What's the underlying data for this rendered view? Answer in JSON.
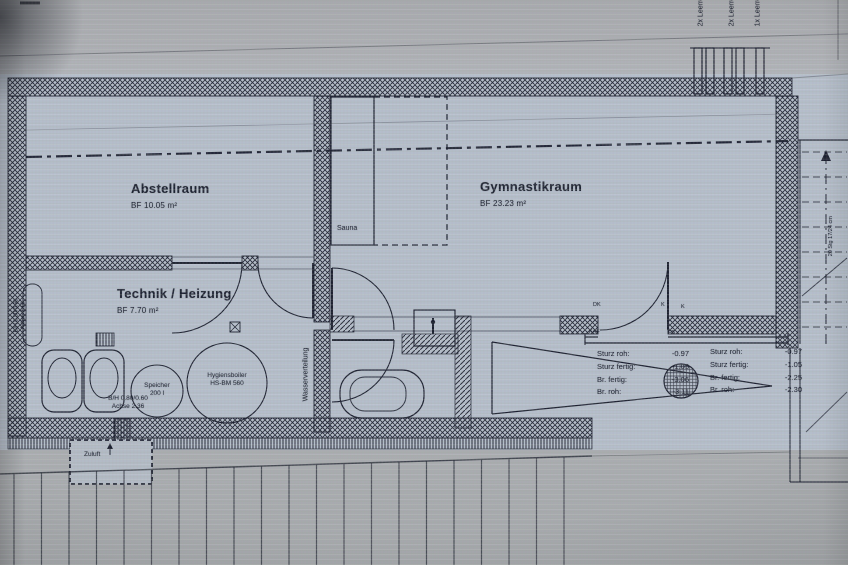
{
  "colors": {
    "paper_blue": "#b4becb",
    "paper_gray_top": "#a9acb1",
    "paper_gray_bottom": "#a5a9ad",
    "ink": "#1d2332",
    "wall_ink": "#1b2030"
  },
  "rooms": {
    "abstellraum": {
      "name": "Abstellraum",
      "area": "BF 10.05 m²"
    },
    "gymnastikraum": {
      "name": "Gymnastikraum",
      "area": "BF 23.23 m²"
    },
    "technik": {
      "name": "Technik / Heizung",
      "area": "BF 7.70 m²"
    },
    "sauna": {
      "name": "Sauna"
    }
  },
  "equipment": {
    "speicher": {
      "line1": "Speicher",
      "line2": "200 l"
    },
    "boiler": {
      "line1": "Hygiensboiler",
      "line2": "HS-BM 560"
    }
  },
  "annotations": {
    "leerrohr1": "2x Leerrohr",
    "leerrohr2": "2x Leerrohr",
    "leerrohr3": "1x Leerrohr",
    "zuluft": "Zuluft",
    "wasserverteilung": "Wasserverteilung",
    "stair_note": "20 Stg 17/24 cm",
    "lintel_wall": {
      "line1": "B/H 0.80/0.60",
      "line2": "Achse 2.16"
    },
    "lintel_technik": {
      "line1": "B/H 0.80/0.60",
      "line2": "Achse 2.36"
    },
    "window_marks": {
      "dk": "DK",
      "k1": "K",
      "k2": "K",
      "kaf": "KAF",
      "fb": "FB"
    }
  },
  "levels": {
    "left": {
      "rows": [
        {
          "label": "Sturz roh:",
          "value": "-0.97"
        },
        {
          "label": "Sturz fertig:",
          "value": "-1.05"
        },
        {
          "label": "Br. fertig:",
          "value": "-3.06"
        },
        {
          "label": "Br. roh:",
          "value": "-3.11"
        }
      ]
    },
    "right": {
      "rows": [
        {
          "label": "Sturz roh:",
          "value": "-0.97"
        },
        {
          "label": "Sturz fertig:",
          "value": "-1.05"
        },
        {
          "label": "Br. fertig:",
          "value": "-2.25"
        },
        {
          "label": "Br. roh:",
          "value": "-2.30"
        }
      ]
    }
  }
}
